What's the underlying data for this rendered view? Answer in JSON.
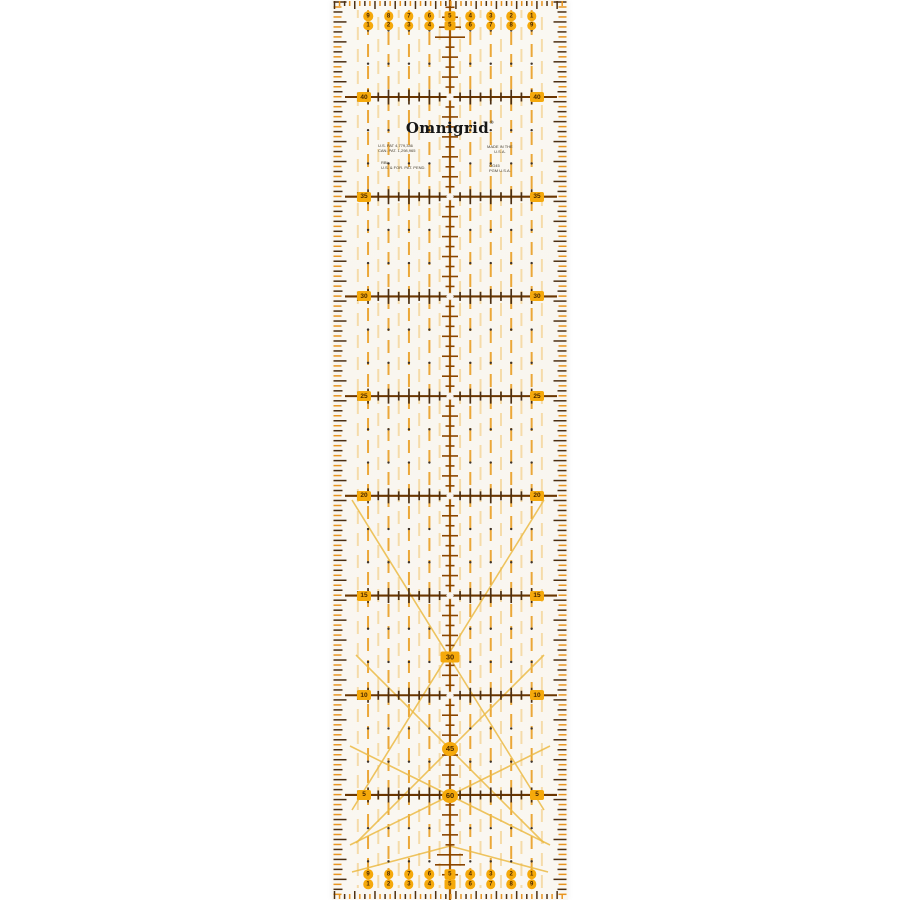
{
  "product": {
    "brand": "Omnigrid",
    "registered_mark": "®",
    "patent_lines": [
      "U.S. PAT 4,779,346",
      "CAN. PAT. 1,298,965"
    ],
    "patent_lines2": [
      "RBL",
      "U.S. & FOR. PAT. PEND."
    ],
    "origin_lines": [
      "MADE IN THE",
      "U.S.A."
    ],
    "origin_lines2": [
      "OG45",
      "PGM U.S.A."
    ]
  },
  "ruler": {
    "unit_system": "metric",
    "width_cm": 10,
    "length_cm": 45,
    "side_scale_labels": [
      "40",
      "35",
      "30",
      "25",
      "20",
      "15",
      "10",
      "5"
    ],
    "edge_numbers_rtl": [
      "9",
      "8",
      "7",
      "6",
      "5",
      "4",
      "3",
      "2",
      "1"
    ],
    "edge_numbers_ltr": [
      "1",
      "2",
      "3",
      "4",
      "5",
      "6",
      "7",
      "8",
      "9"
    ],
    "angle_labels": [
      "30",
      "45",
      "60"
    ],
    "colors": {
      "badge_yellow": "#F5A90B",
      "badge_text": "#4A2800",
      "line_brown": "#6B3600",
      "tick_dark": "#4C2F12",
      "tick_orange": "#E8941F",
      "center_line": "#A55A00",
      "column_orange": "#EBA32F",
      "column_light": "#F5D9A2",
      "diagonal": "#ECBB45",
      "dot": "#3E332A",
      "ruler_body": "#FAF7F1",
      "logo_black": "#161616"
    }
  }
}
